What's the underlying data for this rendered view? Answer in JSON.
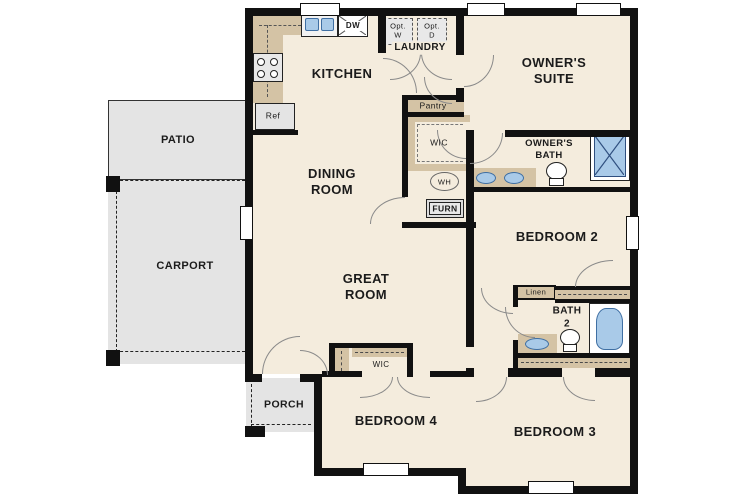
{
  "colors": {
    "floor": "#f4ecdd",
    "wall": "#111111",
    "counter": "#d4c3a5",
    "exterior_gray": "#e4e4e4",
    "fixture_blue": "#a9cae8",
    "fixture_blue_border": "#3f6fa3",
    "door_arc": "#8a8a8a",
    "dashed_line": "#4a4a4a"
  },
  "rooms": {
    "patio": "PATIO",
    "carport": "CARPORT",
    "porch": "PORCH",
    "kitchen": "KITCHEN",
    "dining": "DINING\nROOM",
    "great": "GREAT\nROOM",
    "laundry": "LAUNDRY",
    "owners_suite": "OWNER'S\nSUITE",
    "owners_bath": "OWNER'S\nBATH",
    "bedroom2": "BEDROOM 2",
    "bath2": "BATH\n2",
    "bedroom3": "BEDROOM 3",
    "bedroom4": "BEDROOM 4"
  },
  "closets": {
    "pantry": "Pantry",
    "wic_owner": "WIC",
    "wic_bedroom4": "WIC",
    "linen": "Linen"
  },
  "appliances": {
    "dishwasher": "DW",
    "refrigerator": "Ref",
    "optional_washer": "Opt.\nW",
    "optional_dryer": "Opt.\nD",
    "water_heater": "WH",
    "furnace": "FURN"
  }
}
